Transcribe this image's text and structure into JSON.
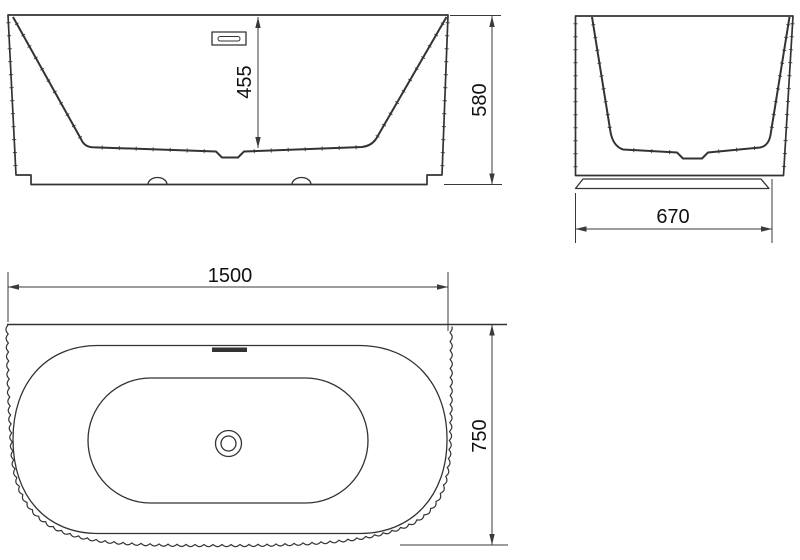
{
  "drawing": {
    "type": "bathtub-technical-drawing",
    "dimensions": {
      "inner_depth": "455",
      "overall_height": "580",
      "overall_width": "670",
      "overall_length": "1500",
      "overall_depth": "750"
    },
    "colors": {
      "line": "#333333",
      "dim": "#3a3a3a",
      "text": "#111111",
      "background": "#ffffff"
    }
  }
}
